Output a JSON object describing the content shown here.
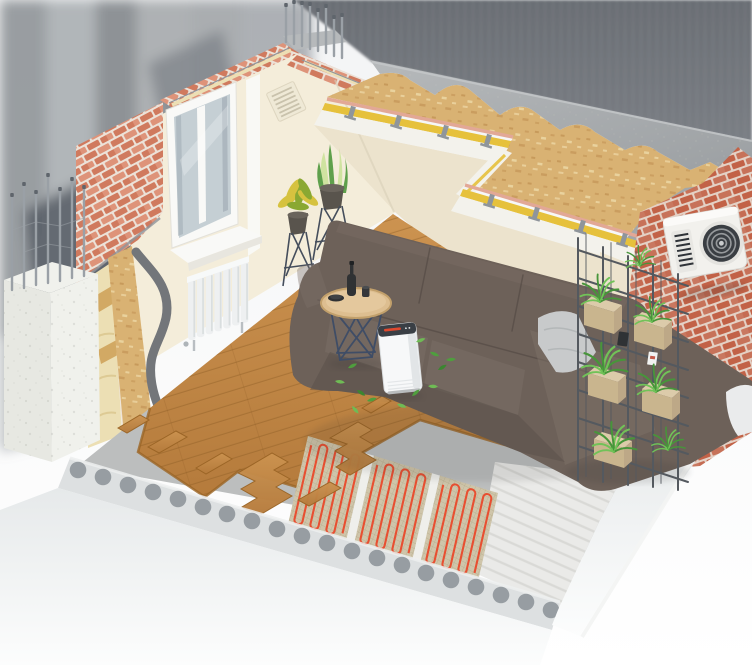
{
  "meta": {
    "title": "Isometric cutaway illustration of a living room showing wall, ceiling and floor construction layers with electric underfloor heating",
    "width_px": 752,
    "height_px": 665,
    "visible_text": "none"
  },
  "palette": {
    "bg_top": "#f3f4f5",
    "bg_bottom": "#ffffff",
    "panel_a": "#6b6f75",
    "panel_b": "#7d8187",
    "streak_1": "#8f9398",
    "streak_2": "#a6aaae",
    "streak_3": "#83878c",
    "streak_4": "#9ca0a4",
    "streak_5": "#8a8e93",
    "streak_6": "#7e838a",
    "slate_1": "#575d66",
    "slate_2": "#6e737a",
    "slate_3": "#84898e",
    "concrete_a": "#b6b9bb",
    "concrete_b": "#9ca0a3",
    "concrete_dk": "#a3a7a9",
    "osb": "#d9b273",
    "osb_dk": "#c09052",
    "osb_lt": "#eed9a8",
    "pink": "#e2a896",
    "ceil_white": "#f3f2ec",
    "joist": "#8f959b",
    "yellow": "#e6c13c",
    "cream": "#f4edda",
    "cream_2": "#ece3cd",
    "cream_dk": "#d9d0b9",
    "brick": "#d07a5e",
    "brick_lt": "#de9379",
    "mortar": "#ece2d8",
    "brick_r": "#c26247",
    "mortar_r": "#e4d1c5",
    "wool": "#ecdfb4",
    "wool_dk": "#d9c48c",
    "stud": "#d2a964",
    "membrane": "#eee3d6",
    "plaster": "#73767a",
    "frame": "#f9f9f7",
    "glass": "#c5cfd4",
    "glass_dk": "#9fabb3",
    "sill_edge": "#e8e6df",
    "radiator": "#eef0f1",
    "radiator_dk": "#d3d8da",
    "wood_a": "#cc9350",
    "wood_b": "#b57b3c",
    "wood_line": "#8a5a22",
    "wood_edge": "#9b6526",
    "screed": "#bcbebe",
    "screed_dk": "#a9abab",
    "mesh": "#cfc5aa",
    "mesh_line": "#b3a888",
    "gap_white": "#efefeb",
    "cable": "#e84f31",
    "white_screed": "#eaeae8",
    "ridge": "#d3d3d0",
    "slab_a": "#e6e9ea",
    "slab_b": "#fcfdfd",
    "band": "#dde0e1",
    "void": "#979da2",
    "pillar_a": "#e7e8e2",
    "pillar_b": "#f0f1ec",
    "rebar": "#9aa0a6",
    "rebar_dk": "#5f656c",
    "sofa": "#6d6159",
    "sofa_lt": "#7d7168",
    "sofa_dk": "#574d46",
    "seam": "#4e453f",
    "pillow": "#c8cacb",
    "pillow_fold": "#aeb1b3",
    "pillow_w": "#eaebec",
    "table_top": "#ddbe90",
    "table_rim": "#c2a06b",
    "wire": "#3f4d66",
    "item_dark": "#303234",
    "purifier": "#f7f8f9",
    "purifier_side": "#e2e5e7",
    "purifier_top": "#3a3f45",
    "p_red": "#e0492e",
    "leaf_a": "#4f9e3e",
    "leaf_b": "#6fbb55",
    "leaf_c": "#3b8630",
    "fern_a": "#47953a",
    "fern_b": "#71c258",
    "sans": "#5fa04c",
    "sans_lt": "#cfe3a0",
    "croton_y": "#d6c23f",
    "croton_g": "#8aa832",
    "pot": "#59544d",
    "pot_rim": "#6a645c",
    "stand": "#454e5c",
    "shelf_wire": "#54595f",
    "shelf_wood": "#dccbaa",
    "shelf_wood_dk": "#c9b58e",
    "ac": "#f2f1ed",
    "fan_dk": "#3a3e43",
    "fan_bl": "#a7aaac",
    "louver": "#2f3338",
    "vent": "#efe9d6",
    "vent_line": "#c9c2ac",
    "shadow": "#2b2b2b"
  },
  "scene": {
    "style": "photorealistic 3D isometric cutaway render on soft gray blurred background",
    "objects": [
      {
        "name": "left-exterior-brick-wall",
        "detail": "red brick facade with cutaway showing mineral wool, wood studs, membrane, OSB and dark plaster S-curve layers"
      },
      {
        "name": "concrete-column",
        "detail": "white concrete pier with exposed vertical rebar rods and tie wires"
      },
      {
        "name": "corner-rebar",
        "detail": "rebar rods protruding from brick wall top corner"
      },
      {
        "name": "window",
        "detail": "white PVC double-pane window with sill"
      },
      {
        "name": "ventilation-grille",
        "detail": "louvered vent on tall cream wall section"
      },
      {
        "name": "radiator",
        "detail": "white sectional panel radiator below window"
      },
      {
        "name": "ceiling-assembly",
        "detail": "stepped cutaway: gray concrete topping over OSB deck, pink board edge, yellow mineral-wool strips between steel furring channels on white ceiling"
      },
      {
        "name": "right-exterior-brick-wall",
        "detail": "red brick wall carrying outdoor air-conditioner unit with round fan and louver grille"
      },
      {
        "name": "shelving-unit",
        "detail": "black metal wireframe grid shelf with light wooden planter boxes and green ferns"
      },
      {
        "name": "sofa",
        "detail": "large taupe leather corner sofa with chaise, gray cushion and white cushion"
      },
      {
        "name": "side-table",
        "detail": "round wooden top on navy wire base with dark bottle, cup and bowl"
      },
      {
        "name": "air-purifier",
        "detail": "white tower purifier with dark top panel, red indicator and floating green leaves"
      },
      {
        "name": "plant-stands",
        "detail": "wire plant stands with croton and sansevieria in gray pots"
      },
      {
        "name": "wood-flooring",
        "detail": "oak plank floor with staircase-shaped cutouts revealing layers below"
      },
      {
        "name": "underfloor-heating",
        "detail": "three electric heating mats: red serpentine cable on beige mesh with white separator strips over gray screed"
      },
      {
        "name": "white-screed",
        "detail": "rough white leveling layer right of heating mats"
      },
      {
        "name": "hollow-core-slab",
        "detail": "concrete slab edge with row of circular voids fading into background"
      }
    ]
  }
}
